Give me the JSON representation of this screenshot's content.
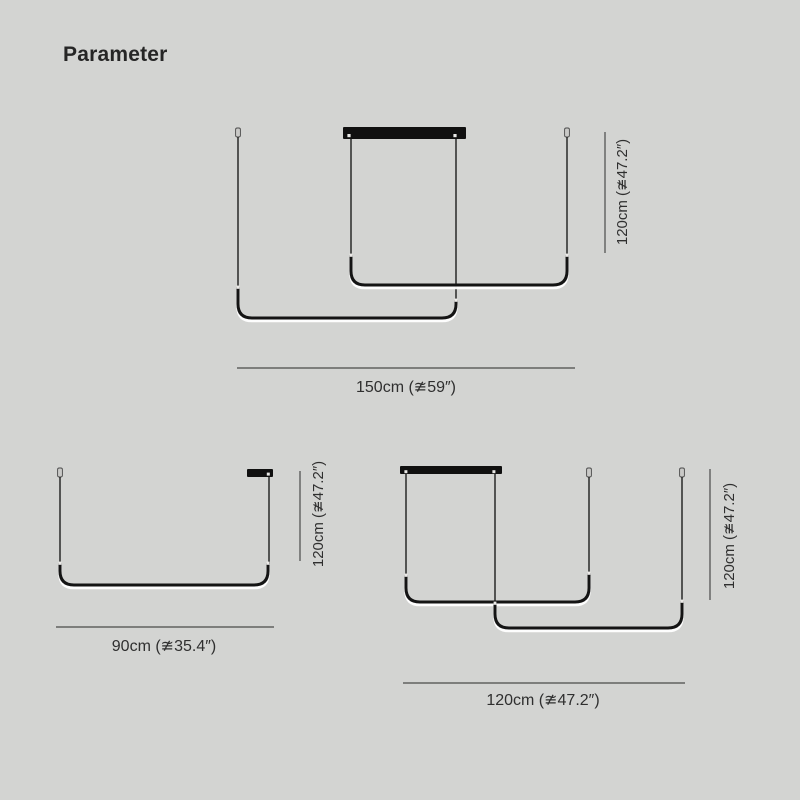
{
  "page": {
    "title": "Parameter"
  },
  "colors": {
    "background": "#d3d4d2",
    "fixture": "#141414",
    "cable": "#1d1d1d",
    "glow": "#ffffff",
    "canopy": "#101010",
    "dimension_line": "#4a4a4a",
    "label_text": "#2f2f2f"
  },
  "diagrams": [
    {
      "name": "two-tier-pendant-150cm",
      "height_label": "120cm (≇47.2″)",
      "width_label": "150cm (≇59″)"
    },
    {
      "name": "single-pendant-90cm",
      "height_label": "120cm (≇47.2″)",
      "width_label": "90cm (≇35.4″)"
    },
    {
      "name": "two-tier-pendant-120cm",
      "height_label": "120cm (≇47.2″)",
      "width_label": "120cm (≇47.2″)"
    }
  ]
}
